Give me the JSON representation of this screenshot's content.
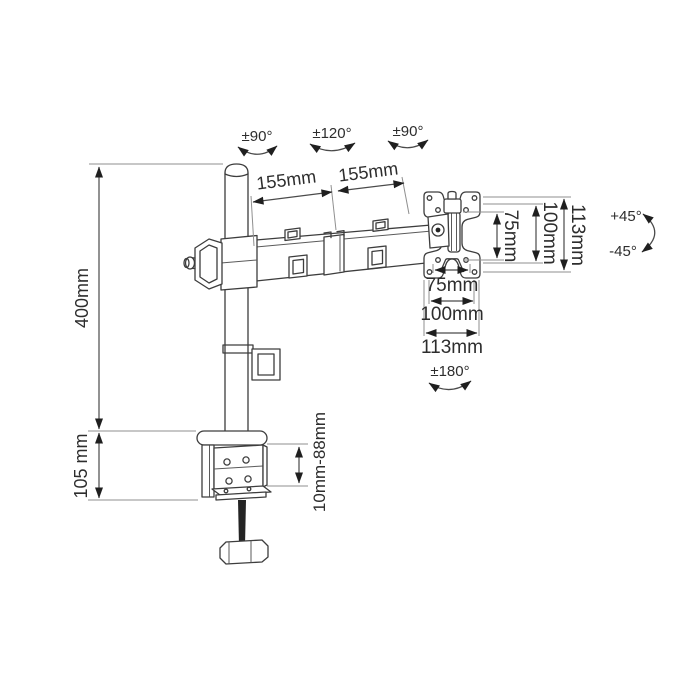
{
  "figure": {
    "type": "technical-dimension-drawing",
    "subject": "single-monitor desk mount arm with C-clamp base",
    "background": "#ffffff",
    "line_color": "#3d3d3d",
    "dimension_line_color": "#4a4a4a",
    "extension_line_color": "#8f8f8f",
    "text_color": "#2d2d2d"
  },
  "rotations": {
    "pole_swivel": "±90°",
    "elbow_swivel": "±120°",
    "head_swivel": "±90°",
    "vesa_rotate": "±180°",
    "tilt_up": "+45°",
    "tilt_down": "-45°"
  },
  "dimensions": {
    "arm_segment_1": "155mm",
    "arm_segment_2": "155mm",
    "pole_height": "400mm",
    "clamp_body_height": "105 mm",
    "clamp_range": "10mm-88mm",
    "vesa_vertical": {
      "inner": "75mm",
      "outer": "100mm",
      "plate": "113mm"
    },
    "vesa_horizontal": {
      "inner": "75mm",
      "outer": "100mm",
      "plate": "113mm"
    }
  }
}
